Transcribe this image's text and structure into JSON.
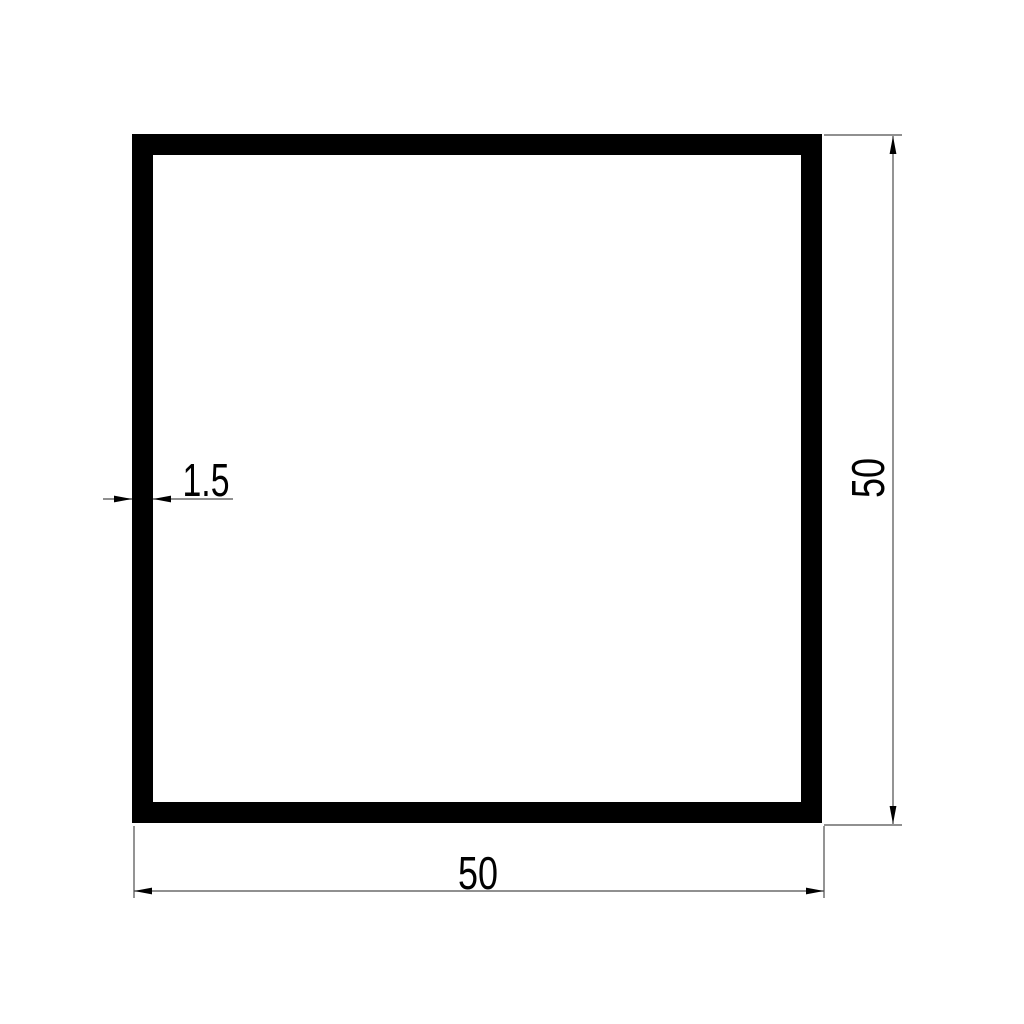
{
  "drawing": {
    "description": "Technical cross-section drawing of a square hollow tube profile",
    "colors": {
      "background": "#ffffff",
      "profile_fill": "#000000",
      "dimension_line": "#4d4d4d",
      "dimension_text": "#000000"
    },
    "dimensions": {
      "outer_width": "50",
      "outer_height": "50",
      "wall_thickness": "1.5"
    }
  }
}
